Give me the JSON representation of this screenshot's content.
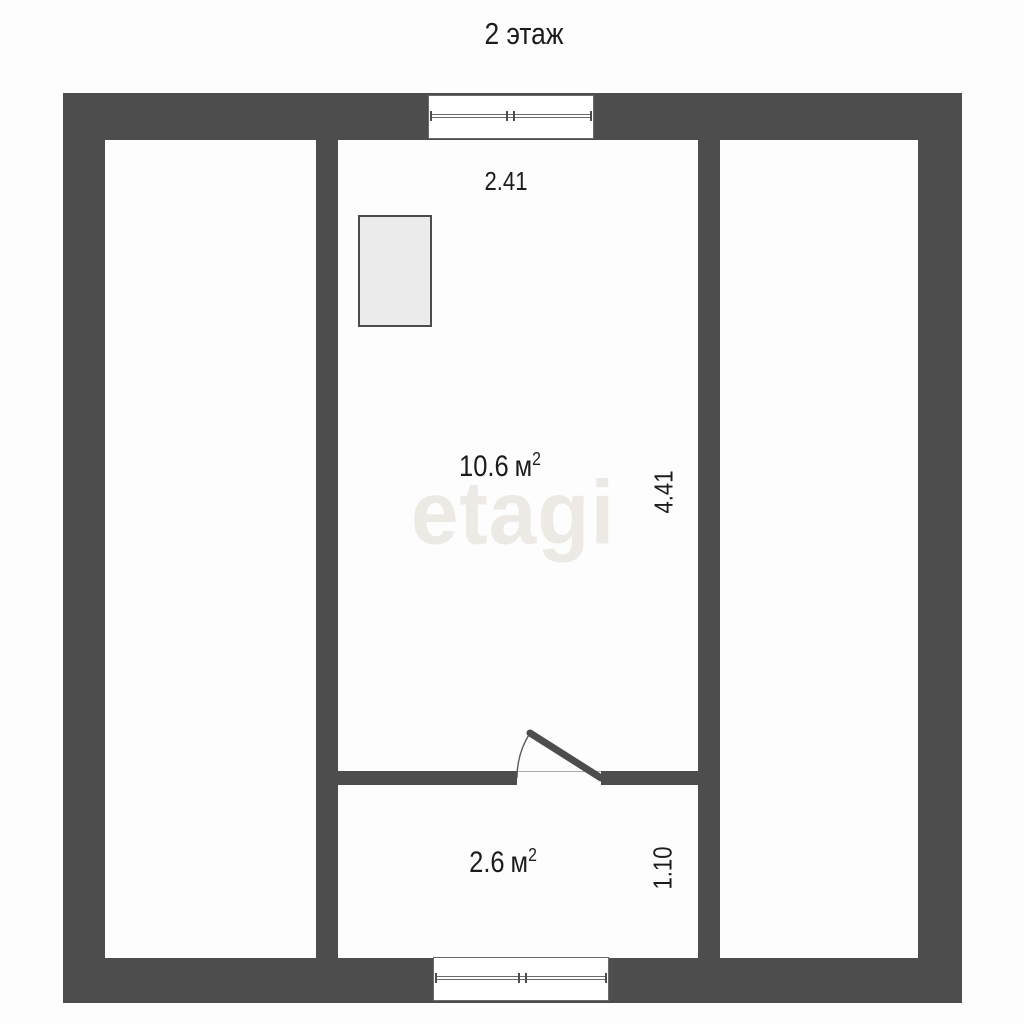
{
  "title": "2 этаж",
  "watermark": "etagi",
  "colors": {
    "wall": "#4d4d4d",
    "background": "#fdfdfd",
    "furniture_fill": "#ebebeb",
    "watermark_text": "#edeae6",
    "label_text": "#1c1c1c"
  },
  "rooms": [
    {
      "name": "room-10-6",
      "area_value": "10.6",
      "area_unit": "м",
      "area_sup": "2",
      "width_dim": "2.41",
      "height_dim": "4.41"
    },
    {
      "name": "hall-2-6",
      "area_value": "2.6",
      "area_unit": "м",
      "area_sup": "2",
      "height_dim": "1.10"
    }
  ]
}
